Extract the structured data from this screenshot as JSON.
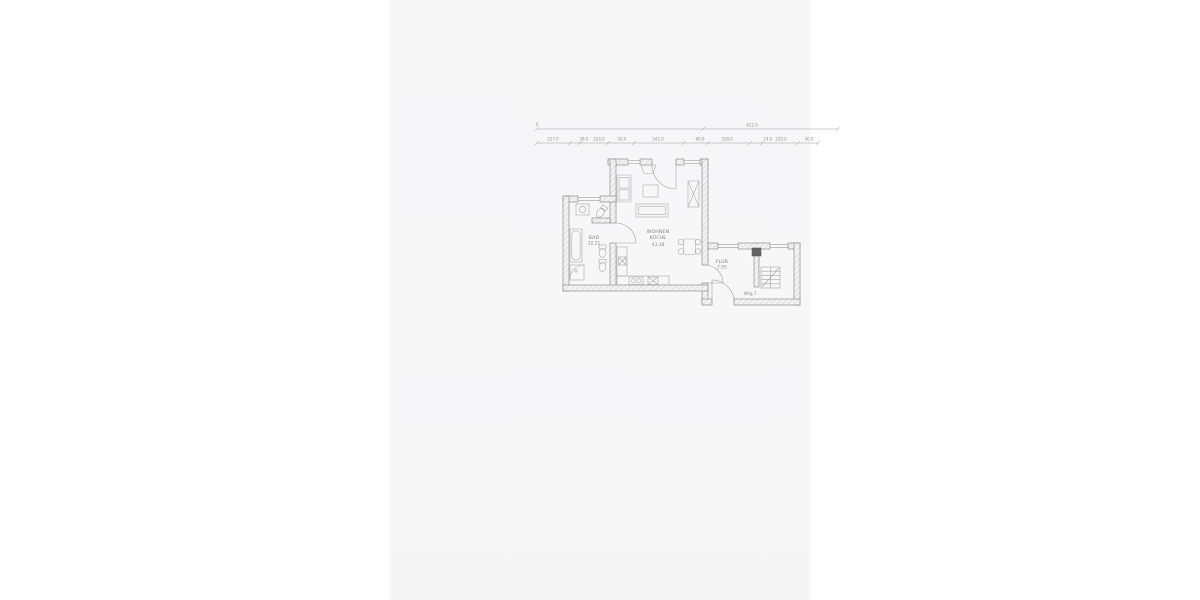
{
  "sheet": {
    "page_background": "#ffffff",
    "scan_background": "#f6f6f7",
    "wall_line_color": "#8f8f8f",
    "hatch_color": "#c6c6c6",
    "furniture_line_color": "#a9a9a9",
    "dimension_line_color": "#9b9b9b",
    "text_color": "#8a8a8a"
  },
  "dimensions": {
    "origin": "0",
    "overall": "812.0",
    "segments": [
      "227.0",
      "38.0",
      "224.0",
      "50.0",
      "542.0",
      "60.0",
      "328.0",
      "24.0",
      "220.0",
      "40.0"
    ]
  },
  "rooms": {
    "bad": {
      "name": "BAD",
      "area": "12,21"
    },
    "wohnen_kueche": {
      "line1": "WOHNEN",
      "line2": "KÜCHE",
      "area": "43,38"
    },
    "flur": {
      "name": "FLUR",
      "area": "7,95"
    },
    "apartment_label": "Whg.7"
  }
}
